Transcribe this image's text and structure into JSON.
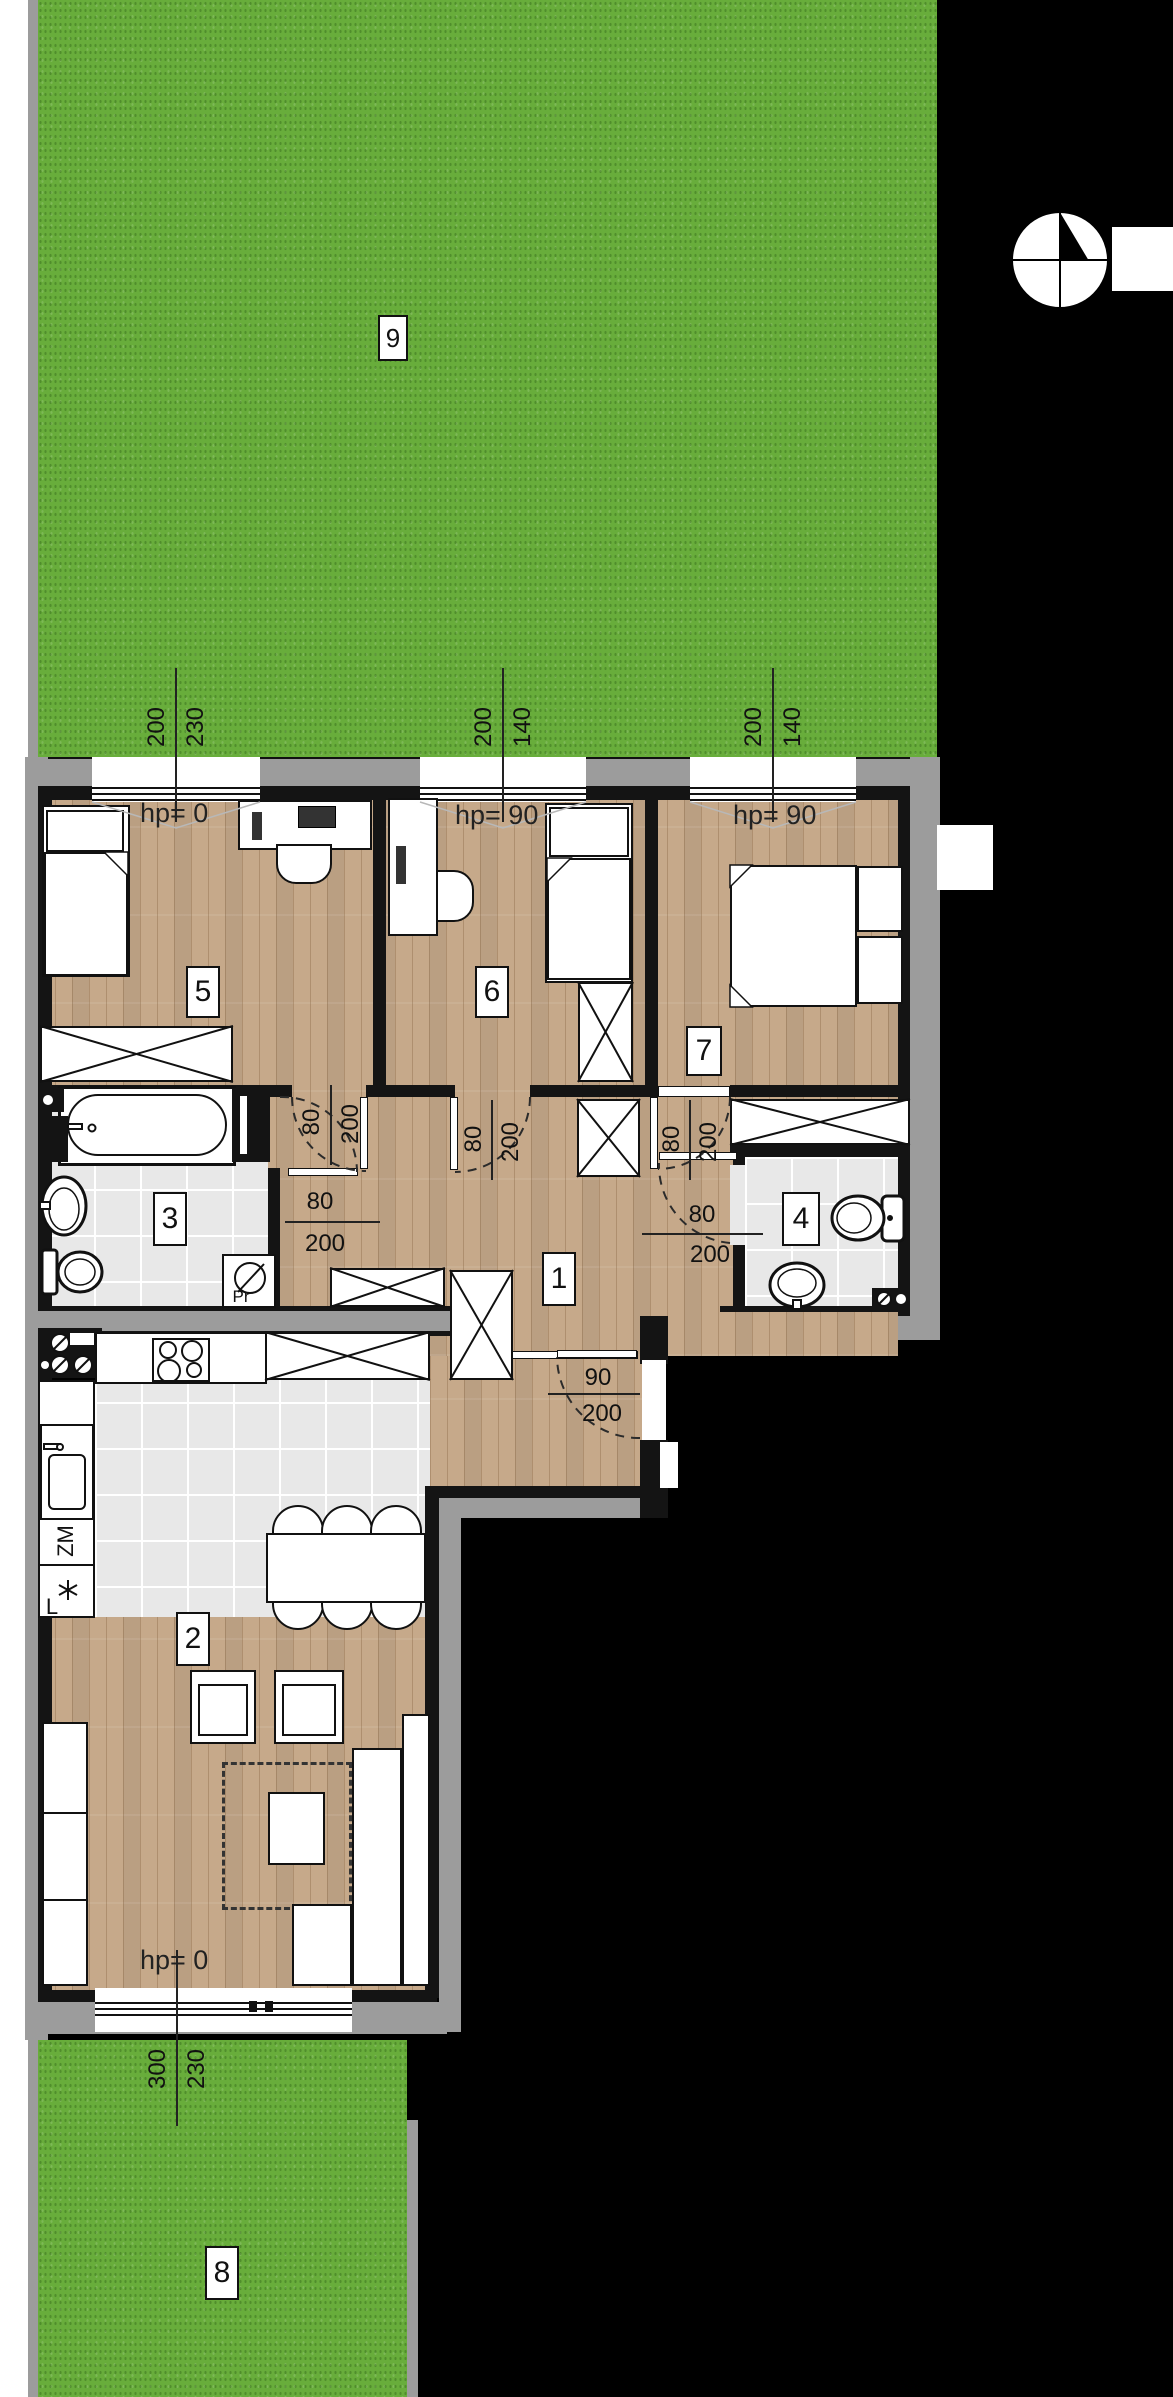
{
  "plan": {
    "type": "apartment floor plan with gardens",
    "rooms": [
      {
        "number": "1",
        "name": "hall"
      },
      {
        "number": "2",
        "name": "living room with kitchenette"
      },
      {
        "number": "3",
        "name": "bathroom"
      },
      {
        "number": "4",
        "name": "wc"
      },
      {
        "number": "5",
        "name": "bedroom"
      },
      {
        "number": "6",
        "name": "bedroom"
      },
      {
        "number": "7",
        "name": "bedroom"
      },
      {
        "number": "8",
        "name": "garden south"
      },
      {
        "number": "9",
        "name": "garden north"
      }
    ],
    "hp_labels": [
      {
        "text": "hp= 0",
        "room": "5"
      },
      {
        "text": "hp= 90",
        "room": "6"
      },
      {
        "text": "hp= 90",
        "room": "7"
      },
      {
        "text": "hp= 0",
        "room": "2"
      }
    ],
    "window_dimensions": [
      {
        "width": "200",
        "sill": "230",
        "location": "bedroom-5-window"
      },
      {
        "width": "200",
        "sill": "140",
        "location": "bedroom-6-window"
      },
      {
        "width": "200",
        "sill": "140",
        "location": "bedroom-7-window"
      },
      {
        "width": "300",
        "sill": "230",
        "location": "living-room-window"
      }
    ],
    "door_dimensions": [
      {
        "width": "80",
        "height": "200",
        "location": "bedroom-5-door"
      },
      {
        "width": "80",
        "height": "200",
        "location": "bedroom-6-door"
      },
      {
        "width": "80",
        "height": "200",
        "location": "bedroom-7-door"
      },
      {
        "width": "80",
        "height": "200",
        "location": "bathroom-door"
      },
      {
        "width": "80",
        "height": "200",
        "location": "wc-door"
      },
      {
        "width": "90",
        "height": "200",
        "location": "entrance-door"
      }
    ],
    "appliance_labels": {
      "dishwasher": "ZM",
      "fridge": "L",
      "washing_machine": "Pr"
    },
    "colors": {
      "grass": "#68ad3b",
      "wood": "#c6a98a",
      "tile": "#e8e8e8",
      "wall": "#141414",
      "exterior": "#9c9c9c",
      "background": "#000000"
    }
  }
}
